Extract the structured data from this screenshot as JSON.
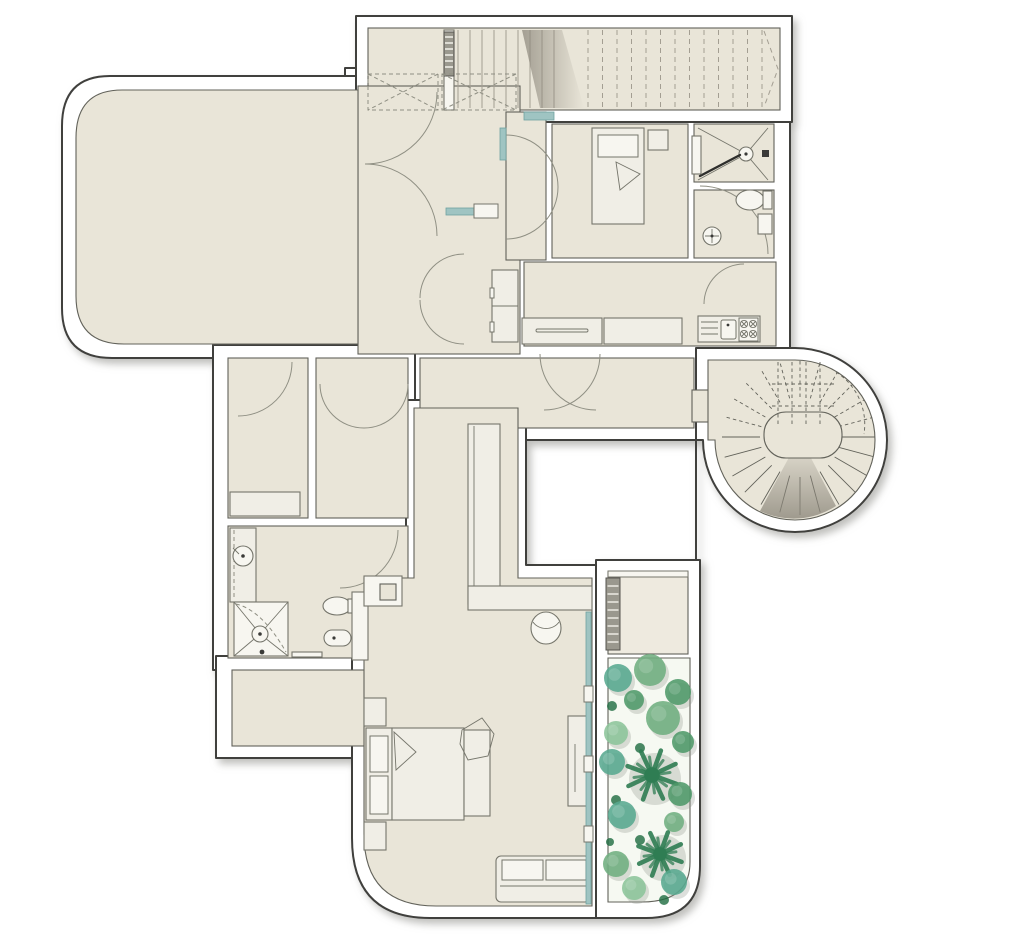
{
  "meta": {
    "description": "Residential architectural floor plan with garage, ramp, spiral staircase, bedrooms, bathrooms, kitchen and planted courtyard garden"
  },
  "colors": {
    "wall_fill": "#ffffff",
    "wall_stroke": "#3f3f3d",
    "floor": "#e9e5d8",
    "floor_light": "#eeeadf",
    "room_stroke": "#62625a",
    "furniture_fill": "#f0eee6",
    "furniture_stroke": "#75756b",
    "glass": "#9fc4c2",
    "glass_dark": "#6fa3a1",
    "arc": "#8f8f83",
    "tread": "#a39e92",
    "ramp_shade": "#8d887c",
    "garden_bg": "#f6f9f2",
    "ladder_fill": "#9a988e",
    "green_mid": "#6fae7f",
    "green_dark": "#4e9969",
    "green_teal": "#58a88f",
    "green_light": "#8cc49a",
    "green_palm": "#2f7d53",
    "green_dot": "#1e6b40",
    "plant_shadow": "#8f948c"
  },
  "ramp": {
    "flights": [
      {
        "target": "ramp-up-flight",
        "style": "tread",
        "count": 9,
        "x_start": 458,
        "x_step": 12,
        "y_top": 30,
        "y_bottom": 108
      },
      {
        "target": "ramp-dashed-flight",
        "style": "dtread",
        "count": 13,
        "x_start": 588,
        "x_step": 14.5,
        "y_top": 30,
        "y_bottom": 108
      }
    ]
  },
  "spiral_stair": {
    "cx": 800,
    "cy": 437,
    "inner_radius": 40,
    "outer_radius": 78,
    "step_angle_deg": 15
  },
  "garden": {
    "ladder": {
      "x": 606,
      "y": 578,
      "w": 14,
      "h": 72,
      "rungs": 8
    },
    "plants": [
      {
        "x": 618,
        "y": 678,
        "r": 14,
        "c": "green_teal",
        "t": "bush"
      },
      {
        "x": 650,
        "y": 670,
        "r": 16,
        "c": "green_mid",
        "t": "bush"
      },
      {
        "x": 678,
        "y": 692,
        "r": 13,
        "c": "green_dark",
        "t": "bush"
      },
      {
        "x": 612,
        "y": 706,
        "r": 5,
        "c": "green_dot",
        "t": "dot"
      },
      {
        "x": 634,
        "y": 700,
        "r": 10,
        "c": "green_dark",
        "t": "bush"
      },
      {
        "x": 663,
        "y": 718,
        "r": 17,
        "c": "green_mid",
        "t": "bush"
      },
      {
        "x": 683,
        "y": 742,
        "r": 11,
        "c": "green_dark",
        "t": "bush"
      },
      {
        "x": 616,
        "y": 733,
        "r": 12,
        "c": "green_light",
        "t": "bush"
      },
      {
        "x": 640,
        "y": 748,
        "r": 5,
        "c": "green_dot",
        "t": "dot"
      },
      {
        "x": 612,
        "y": 762,
        "r": 13,
        "c": "green_teal",
        "t": "bush"
      },
      {
        "x": 652,
        "y": 775,
        "r": 26,
        "c": "green_palm",
        "t": "palm"
      },
      {
        "x": 680,
        "y": 794,
        "r": 12,
        "c": "green_dark",
        "t": "bush"
      },
      {
        "x": 616,
        "y": 800,
        "r": 5,
        "c": "green_dot",
        "t": "dot"
      },
      {
        "x": 622,
        "y": 815,
        "r": 14,
        "c": "green_teal",
        "t": "bush"
      },
      {
        "x": 674,
        "y": 822,
        "r": 10,
        "c": "green_mid",
        "t": "bush"
      },
      {
        "x": 640,
        "y": 840,
        "r": 5,
        "c": "green_dot",
        "t": "dot"
      },
      {
        "x": 610,
        "y": 842,
        "r": 4,
        "c": "green_dot",
        "t": "dot"
      },
      {
        "x": 660,
        "y": 854,
        "r": 23,
        "c": "green_palm",
        "t": "palm"
      },
      {
        "x": 616,
        "y": 864,
        "r": 13,
        "c": "green_mid",
        "t": "bush"
      },
      {
        "x": 674,
        "y": 882,
        "r": 13,
        "c": "green_teal",
        "t": "bush"
      },
      {
        "x": 634,
        "y": 888,
        "r": 12,
        "c": "green_light",
        "t": "bush"
      },
      {
        "x": 664,
        "y": 900,
        "r": 5,
        "c": "green_dot",
        "t": "dot"
      }
    ]
  }
}
